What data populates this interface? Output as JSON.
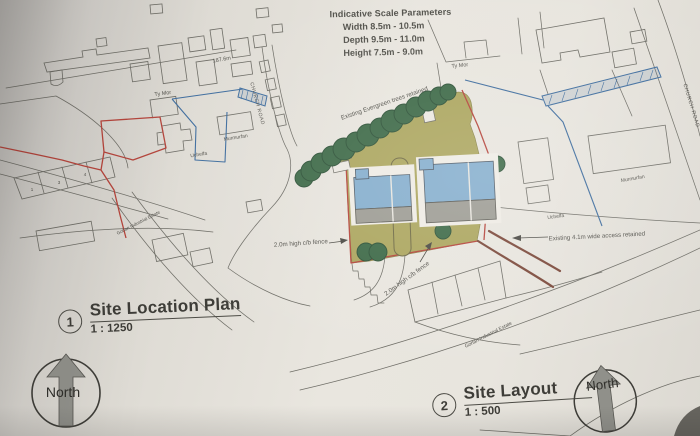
{
  "scale_parameters": {
    "title": "Indicative Scale Parameters",
    "width": "Width 8.5m - 10.5m",
    "depth": "Depth 9.5m - 11.0m",
    "height": "Height 7.5m - 9.0m"
  },
  "location_plan": {
    "number": "1",
    "title": "Site Location Plan",
    "scale": "1 : 1250",
    "labels": {
      "spot_height": "187.6m",
      "ty_mor": "Ty Mor",
      "murmurfan": "Murmurfan",
      "uchelfa": "Uchelfa",
      "church_road": "CHURCH ROAD",
      "industrial_estate": "Gorlan Industrial Estate",
      "unit_1": "1",
      "unit_3": "3",
      "unit_4": "4"
    }
  },
  "site_layout": {
    "number": "2",
    "title": "Site Layout",
    "scale": "1 : 500",
    "labels": {
      "ty_mor": "Ty Mor",
      "evergreen_trees": "Existing Evergreen trees retained",
      "fence_west": "2.0m high c/b fence",
      "fence_south": "2.0m high c/b fence",
      "access": "Existing 4.1m wide access retained",
      "murmurfan": "Murmurfan",
      "uchelfa": "Uchelfa",
      "church_road": "CHURCH ROAD",
      "industrial_estate": "Gorlan Industrial Estate"
    }
  },
  "north_arrow": {
    "label": "North"
  },
  "colors": {
    "paper": "#e7e4dd",
    "ink": "#6e6d66",
    "red_boundary": "#b5453c",
    "dark_red": "#7c4a3c",
    "blue_line": "#3f6d9e",
    "site_ground": "#aca65f",
    "tree_green": "#3e6a48",
    "roof_blue": "#85aecd",
    "roof_gray": "#9d9c94",
    "north_gray": "#90908a"
  }
}
